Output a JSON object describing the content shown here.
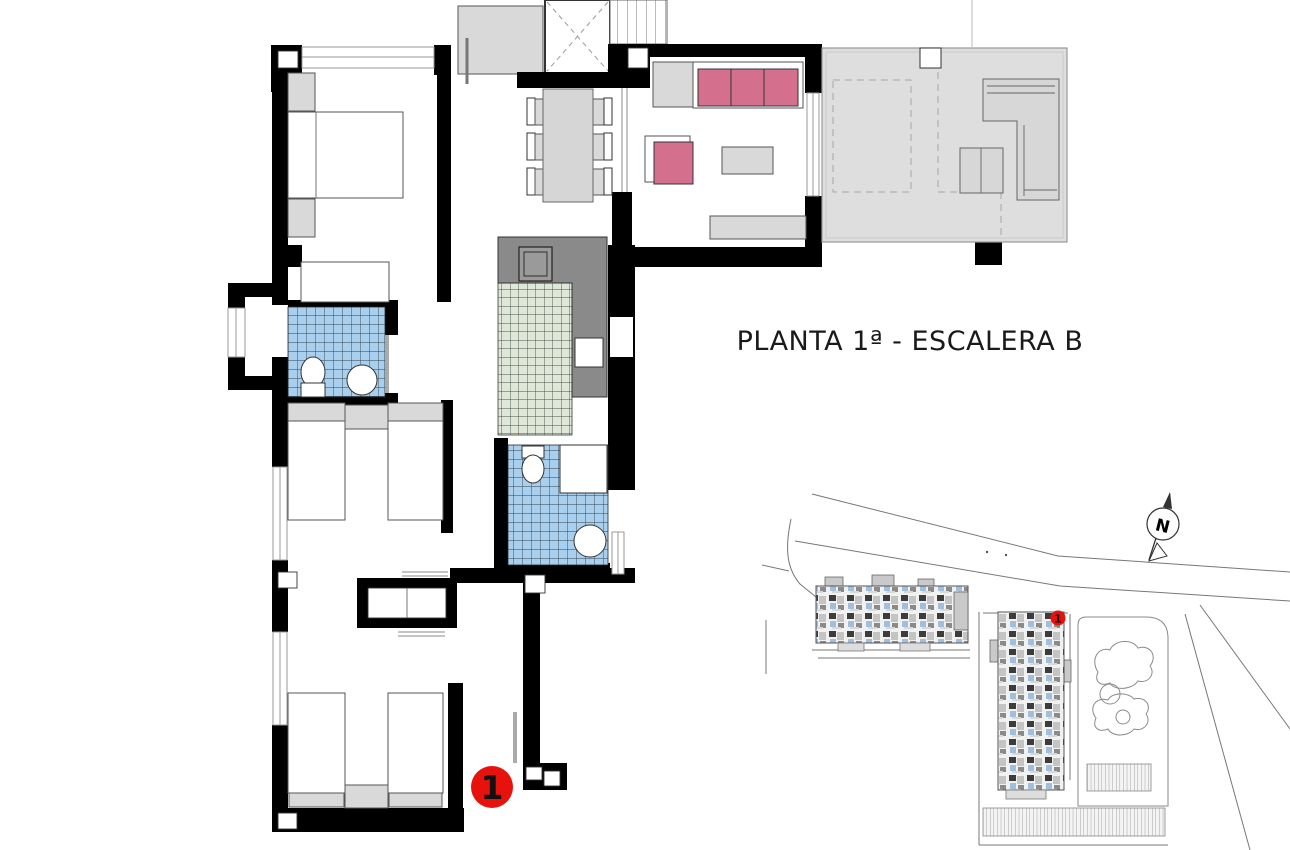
{
  "title": "PLANTA 1ª - ESCALERA B",
  "floor_marker": {
    "label": "1"
  },
  "site_plan": {
    "marker_label": "1"
  },
  "compass": {
    "label": "N"
  },
  "colors": {
    "wall": "#000000",
    "line": "#555555",
    "furn": "#d9d9d9",
    "terrace": "#dedede",
    "counter": "#8a8a8a",
    "tileblue": "#a9cfee",
    "tilegreen": "#dfe8d8",
    "sofa": "#d4708d",
    "red": "#e8120c",
    "site": "#777777",
    "title": "#1a1a1a"
  }
}
